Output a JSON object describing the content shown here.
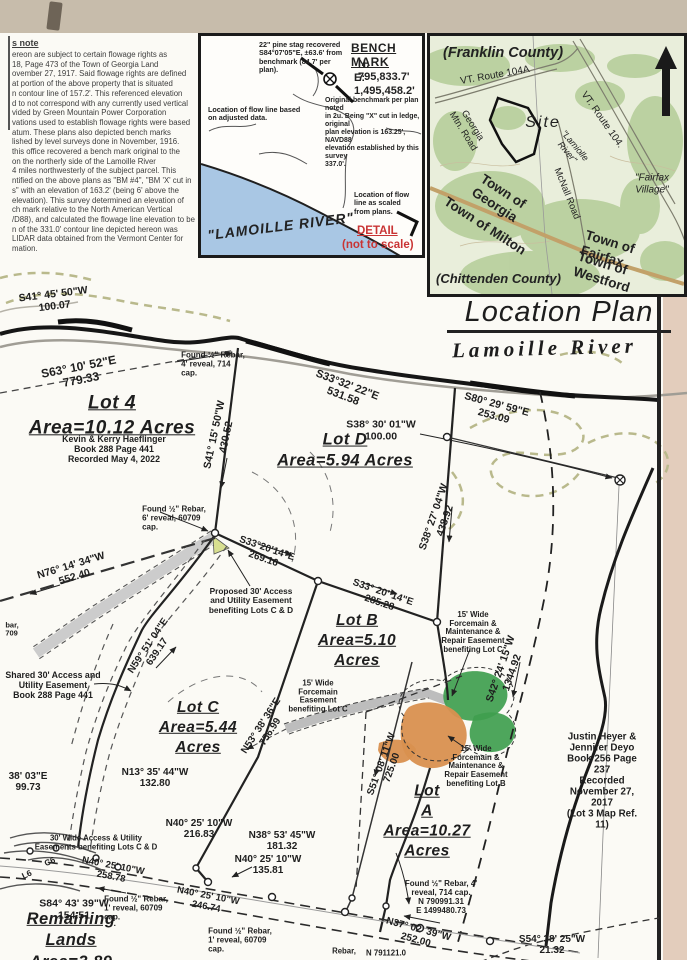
{
  "colors": {
    "paper": "#fbfaf5",
    "tan_top": "#c7bcab",
    "tan_right": "#e3cdbc",
    "water": "#a9c7e4",
    "green": "#3f9e4e",
    "orange": "#d9904f",
    "red": "#c93434",
    "highlight": "#d8df90"
  },
  "notes": {
    "title": "s note",
    "body": "ereon are subject to certain flowage rights as\n18, Page 473 of the Town of Georgia Land\november 27, 1917. Said flowage rights are defined\nat portion of the above property that is situated\nn contour line of 157.2'. This referenced elevation\nd to not correspond with any currently used vertical\nvided by Green Mountain Power Corporation\nvations used to establish flowage rights were based\natum. These plans also depicted bench marks\nlished by level surveys done in November, 1916.\nthis office recovered a bench mark original to the\non the northerly side of the Lamoille River\n4 miles northwesterly of the subject parcel. This\nntified on the above plans as \"BM #4\", \"BM 'X' cut in\ns\" with an elevation of 163.2' (being 6' above the\nelevation). This survey determined an elevation of\nch mark relative to the North American Vertical\n/D88), and calculated the flowage line elevation to be\nn of the 331.0' contour line depicted hereon was\nLIDAR data obtained from the Vermont Center for\nmation."
  },
  "benchmark_inset": {
    "pine_note": "22\" pine stag recovered\nS84°07'05\"E, ±63.6' from\nbenchmark (84.7' per\nplan).",
    "title": "BENCH MARK",
    "northing": "N: 795,833.7'",
    "easting": "E: 1,495,458.2'",
    "flow_adjusted_note": "Location of flow line based\non adjusted data.",
    "original_note": "Original benchmark per plan noted\nin 2u. Being \"X\" cut in ledge, original\nplan elevation is 163.25', NAVD88\nelevation established by this survey\n337.0'.",
    "river_label": "\"LAMOILLE RIVER\"",
    "flow_scaled_note": "Location of flow\nline as scaled\nfrom plans.",
    "detail_label": "DETAIL",
    "not_to_scale": "(not to scale)"
  },
  "location_inset": {
    "county_top": "(Franklin County)",
    "county_bottom": "(Chittenden County)",
    "route_104a": "VT. Route 104A",
    "route_104": "VT. Route 104.",
    "georgia_mtn_road": "Georgia\nMtn. Road",
    "site": "Site",
    "river": "\"Lamiolle\nRiver\"",
    "mcnall_road": "McNall Road",
    "fairfax_village": "\"Fairfax\nVillage\"",
    "town_georgia": "Town of\nGeorgia",
    "town_milton": "Town of Milton",
    "town_fairfax": "Town of Fairfax",
    "town_westford": "Town of Westford"
  },
  "titles": {
    "location_plan": "Location Plan",
    "river": "Lamoille River"
  },
  "map": {
    "s41_45": "S41° 45' 50\"W\n100.07",
    "s63": "S63° 10' 52\"E\n779.33",
    "found_rebar_top": "Found ½\" Rebar,\n4' reveal, 714\ncap.",
    "lot4": "Lot 4\nArea=10.12 Acres",
    "lot4_owner": "Kevin & Kerry Haeflinger\nBook 288 Page 441\nRecorded May 4, 2022",
    "s41_15": "S41° 15' 50\"W\n430.52",
    "s33_32": "S33°32' 22\"E\n531.58",
    "lotD": "Lot D\nArea=5.94 Acres",
    "s38_30": "S38° 30' 01\"W\n100.00",
    "s80": "S80° 29' 59\"E\n253.09",
    "s38_27": "S38° 27' 04\"W\n438.92",
    "found_rebar_mid": "Found ½\" Rebar,\n6' reveal, 60709\ncap.",
    "n76": "N76° 14' 34\"W\n552.40",
    "s33_20_a": "S33°20'14\"E\n269.16",
    "proposed_30": "Proposed 30' Access\nand Utility Easement\nbenefiting Lots C & D",
    "s33_20_b": "S33° 20' 14\"E\n285.28",
    "lotB": "Lot B\nArea=5.10\nAcres",
    "forcemain_c_small": "15' Wide\nForcemain\nEasement\nbenefiting Lot C",
    "forcemain_c_big": "15' Wide\nForcemain &\nMaintenance &\nRepair Easement\nbenefiting Lot C",
    "s42": "S42° 24' 15\"W\n1344.92",
    "heyer": "Justin Heyer & Jennifer Deyo\nBook 256 Page 237\nRecorded November 27, 2017\n(Lot 3 Map Ref. 11)",
    "shared_30": "Shared 30' Access and\nUtility Easement\nBook 288 Page 441",
    "n59": "N59° 51' 04\"E\n639.17",
    "edge_bar": "bar,\n709",
    "edge_38": "38' 03\"E\n99.73",
    "n13": "N13° 35' 44\"W\n132.80",
    "lotC": "Lot C\nArea=5.44\nAcres",
    "n53": "N53° 38' 36\"E\n756.99",
    "wide_30": "30' Wide Access & Utility\nEasements benefiting Lots C & D",
    "n40_216": "N40° 25' 10\"W\n216.83",
    "n38_53": "N38° 53' 45\"W\n181.32",
    "n40_135": "N40° 25' 10\"W\n135.81",
    "road_258": "N40° 25' 10\"W\n258.78",
    "road_246": "N40° 25' 10\"W\n246.74",
    "s84": "S84° 43' 39\"W\n154.51",
    "found_rebar_low": "Found ½\" Rebar,\n1' reveal, 60709\ncap.",
    "remaining": "Remaining\nLands\nArea=3.89",
    "lotA": "Lot\nA\nArea=10.27\nAcres",
    "s51": "S51° 08' 11\"W\n725.00",
    "forcemain_b": "15' Wide\nForcemain &\nMaintenance &\nRepair Easement\nbenefiting Lot B",
    "found_rebar_coords": "Found ½\" Rebar, 4'\nreveal, 714 cap.\nN 790991.31\nE 1499480.73",
    "n37": "N37° 02' 39\"W\n252.00",
    "s54": "S54° 38' 25\"W\n21.32",
    "frag_rebar": "Rebar,",
    "frag_coord": "N 791121.0",
    "found_rebar_bottom": "Found ½\" Rebar,\n1' reveal, 60709\ncap.",
    "c6": "C6",
    "l6": "L6"
  }
}
